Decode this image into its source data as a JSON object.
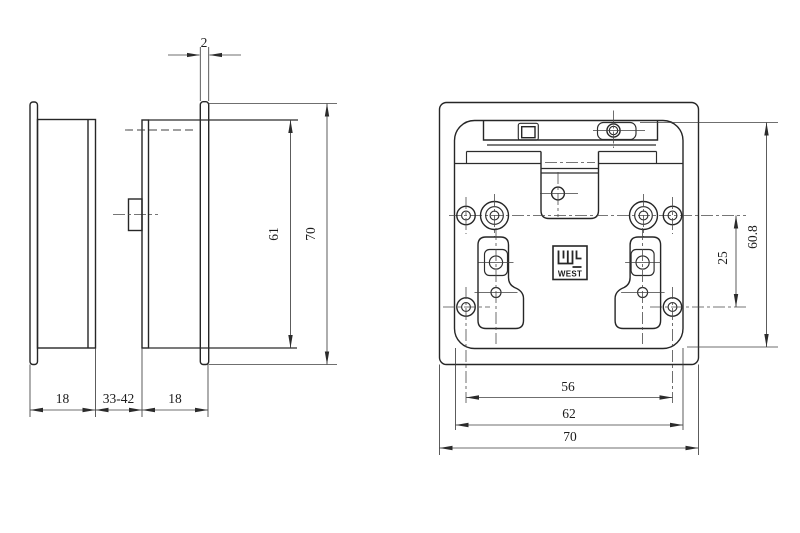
{
  "side_view": {
    "dim_flange_thickness": "2",
    "dim_inner_height": "61",
    "dim_overall_height": "70",
    "dim_rear_depth": "18",
    "dim_panel_range": "33-42",
    "dim_front_depth": "18"
  },
  "rear_view": {
    "dim_inner_height": "60.8",
    "dim_hole_pitch_v": "25",
    "dim_hole_span_h": "56",
    "dim_inner_width": "62",
    "dim_overall_width": "70",
    "logo_text": "WEST"
  },
  "colors": {
    "background": "#ffffff",
    "object_line": "#262626",
    "dimension_line": "#3f3f3f",
    "text": "#1c1c1c"
  }
}
